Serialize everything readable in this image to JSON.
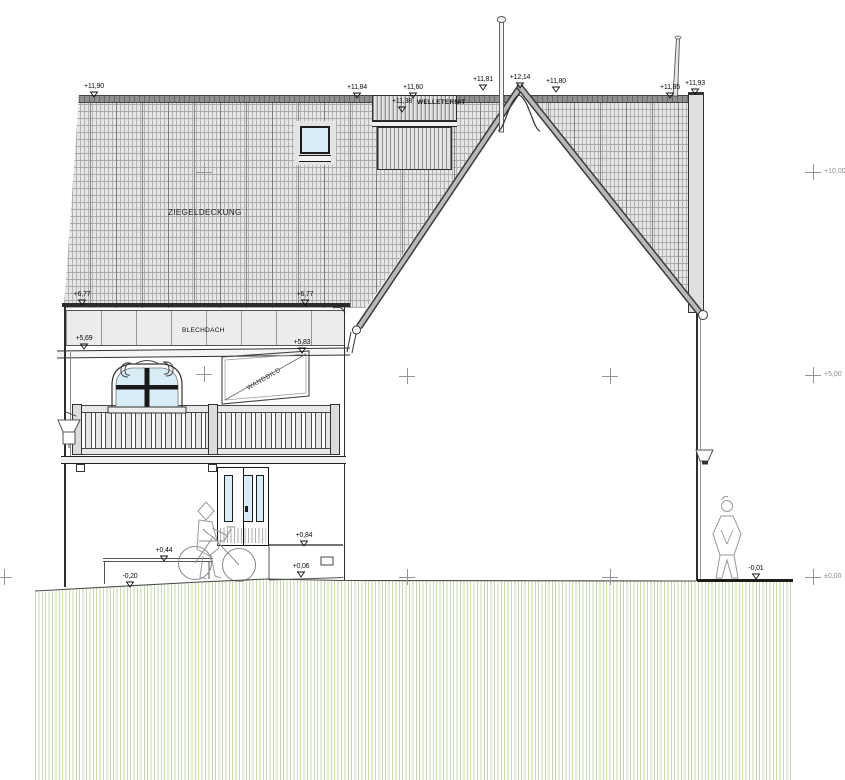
{
  "drawing": {
    "title": "building elevation",
    "labels": {
      "roof_material": "ZIEGELDECKUNG",
      "eave_band_material": "BLECHDACH",
      "dormer_material": "WELLETERNIT",
      "wall_panel": "WANDBILD"
    },
    "elevation_markers": [
      {
        "text": "+11,90",
        "x": 94,
        "y": 83
      },
      {
        "text": "+11,84",
        "x": 357,
        "y": 84
      },
      {
        "text": "+11,60",
        "x": 413,
        "y": 84
      },
      {
        "text": "+11,38",
        "x": 402,
        "y": 98
      },
      {
        "text": "+11,81",
        "x": 483,
        "y": 76
      },
      {
        "text": "+12,14",
        "x": 520,
        "y": 74
      },
      {
        "text": "+11,80",
        "x": 556,
        "y": 78
      },
      {
        "text": "+11,85",
        "x": 670,
        "y": 84
      },
      {
        "text": "+11,93",
        "x": 695,
        "y": 80
      },
      {
        "text": "+6,77",
        "x": 82,
        "y": 291
      },
      {
        "text": "+6,77",
        "x": 305,
        "y": 291
      },
      {
        "text": "+5,69",
        "x": 84,
        "y": 335
      },
      {
        "text": "+5,83",
        "x": 302,
        "y": 339
      },
      {
        "text": "+0,84",
        "x": 304,
        "y": 532
      },
      {
        "text": "+0,44",
        "x": 164,
        "y": 547
      },
      {
        "text": "+0,06",
        "x": 301,
        "y": 563
      },
      {
        "text": "-0,20",
        "x": 130,
        "y": 573
      },
      {
        "text": "-0,01",
        "x": 756,
        "y": 565
      }
    ],
    "grid_refs": [
      {
        "label": "+10,00",
        "x": 813,
        "y": 172
      },
      {
        "label": "+5,00",
        "x": 813,
        "y": 375
      },
      {
        "label": "±0,00",
        "x": 813,
        "y": 577
      }
    ],
    "grid_crosses": [
      [
        204,
        172
      ],
      [
        204,
        374
      ],
      [
        407,
        376
      ],
      [
        610,
        376
      ],
      [
        4,
        577
      ],
      [
        407,
        577
      ],
      [
        610,
        577
      ]
    ],
    "colors": {
      "glass": "#d9edf6",
      "ground_hatch": "#c6daae",
      "roof_base": "#e6e6e6"
    }
  }
}
